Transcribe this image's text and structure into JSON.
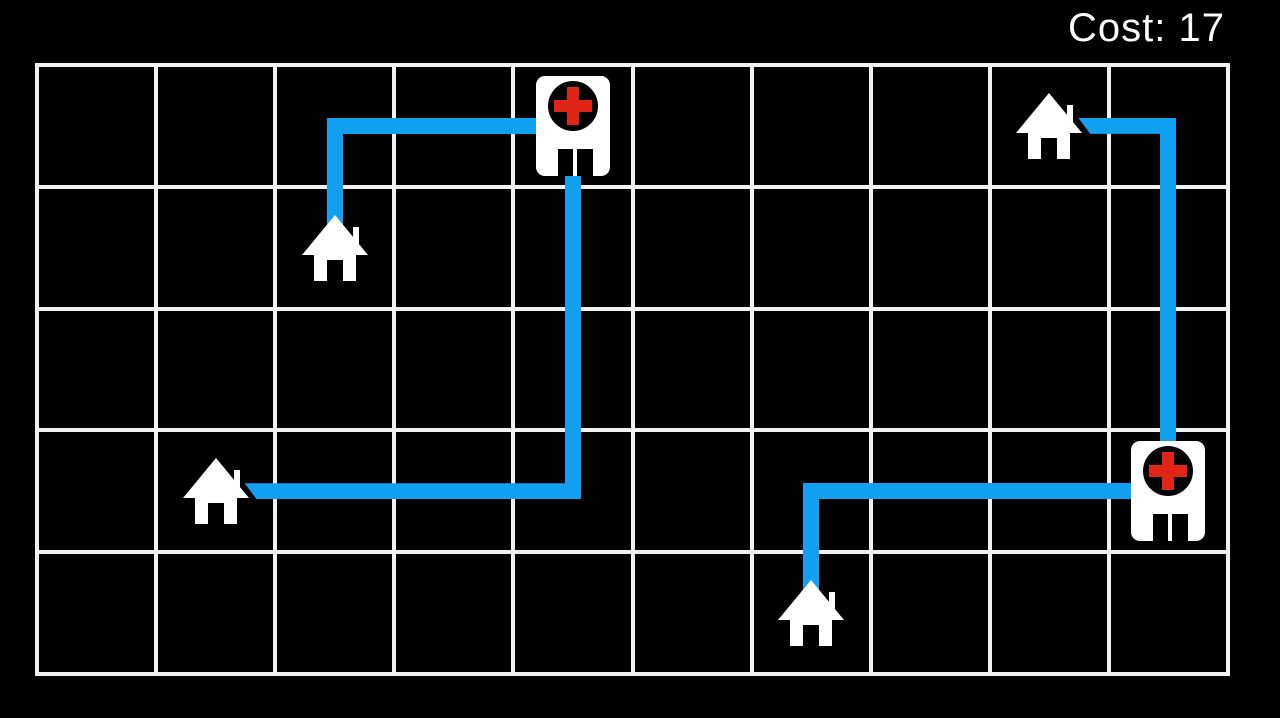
{
  "hud": {
    "cost_label": "Cost:",
    "cost_value": "17",
    "cost_text": "Cost: 17"
  },
  "board": {
    "cols": 10,
    "rows": 5,
    "left": 37,
    "top": 65,
    "right": 1228,
    "bottom": 674,
    "grid_line_width": 4,
    "grid_line_color": "#f2f2f2",
    "background_color": "#000000"
  },
  "colors": {
    "route_blue": "#12A0F3",
    "cross_red": "#E02418",
    "building_white": "#ffffff",
    "door_black": "#000000"
  },
  "path_thickness": 16,
  "entities": [
    {
      "id": "hospital-1",
      "type": "hospital",
      "col": 4,
      "row": 0
    },
    {
      "id": "hospital-2",
      "type": "hospital",
      "col": 9,
      "row": 3
    },
    {
      "id": "house-1",
      "type": "house",
      "col": 2,
      "row": 1
    },
    {
      "id": "house-2",
      "type": "house",
      "col": 1,
      "row": 3
    },
    {
      "id": "house-3",
      "type": "house",
      "col": 8,
      "row": 0
    },
    {
      "id": "house-4",
      "type": "house",
      "col": 6,
      "row": 4
    }
  ],
  "routes": [
    {
      "id": "route-1",
      "from": "house-1",
      "to": "hospital-1",
      "waypoints": [
        [
          2,
          1
        ],
        [
          2,
          0
        ],
        [
          4,
          0
        ]
      ]
    },
    {
      "id": "route-2",
      "from": "hospital-1",
      "to": "house-2",
      "waypoints": [
        [
          4,
          0
        ],
        [
          4,
          3
        ],
        [
          1,
          3
        ]
      ]
    },
    {
      "id": "route-3",
      "from": "house-3",
      "to": "hospital-2",
      "waypoints": [
        [
          8,
          0
        ],
        [
          9,
          0
        ],
        [
          9,
          3
        ]
      ]
    },
    {
      "id": "route-4",
      "from": "hospital-2",
      "to": "house-4",
      "waypoints": [
        [
          9,
          3
        ],
        [
          6,
          3
        ],
        [
          6,
          4
        ]
      ]
    }
  ]
}
